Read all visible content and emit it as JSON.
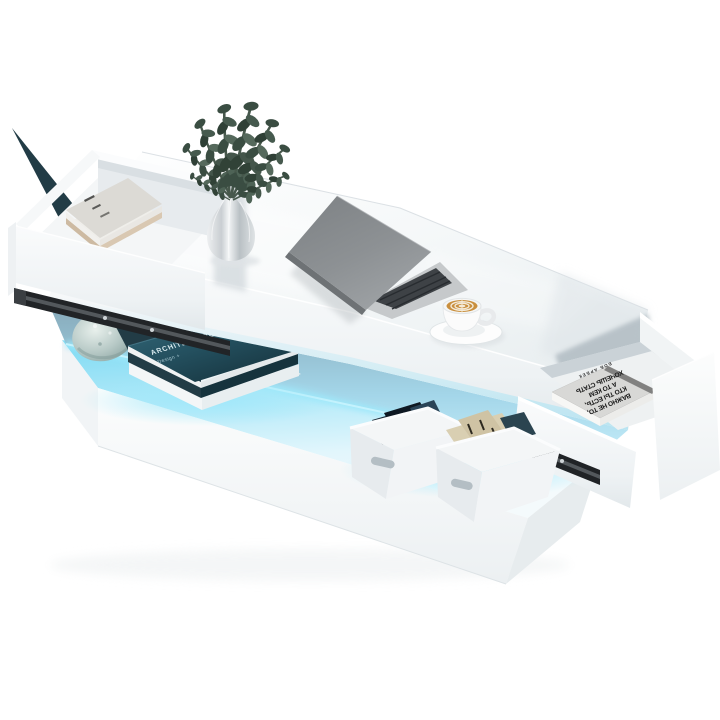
{
  "scene": {
    "description": "Product photo of a white high-gloss LED coffee table with two open drawers, lighted open shelf, laptop, plant vase and cappuccino on top",
    "background_color": "#ffffff",
    "table_color": "#f7f9fa",
    "led_glow_color": "#7edaf3",
    "led_strip_color": "#c9f4fe",
    "laptop_color": "#8b8e91",
    "latte_color": "#c98f3e",
    "teal_book_color": "#2a5a68"
  },
  "books": {
    "architecture": {
      "title": "ARCHITECTURE",
      "subtitle": "Design +"
    },
    "quote": {
      "line1": "ВАЖНО НЕ ТО,",
      "line2": "КТО ТЫ ЕСТЬ,",
      "line3": "А ТО КЕМ",
      "line4": "ХОЧЕШЬ СТАТЬ",
      "author": "БОБ  АРБЕК"
    }
  }
}
